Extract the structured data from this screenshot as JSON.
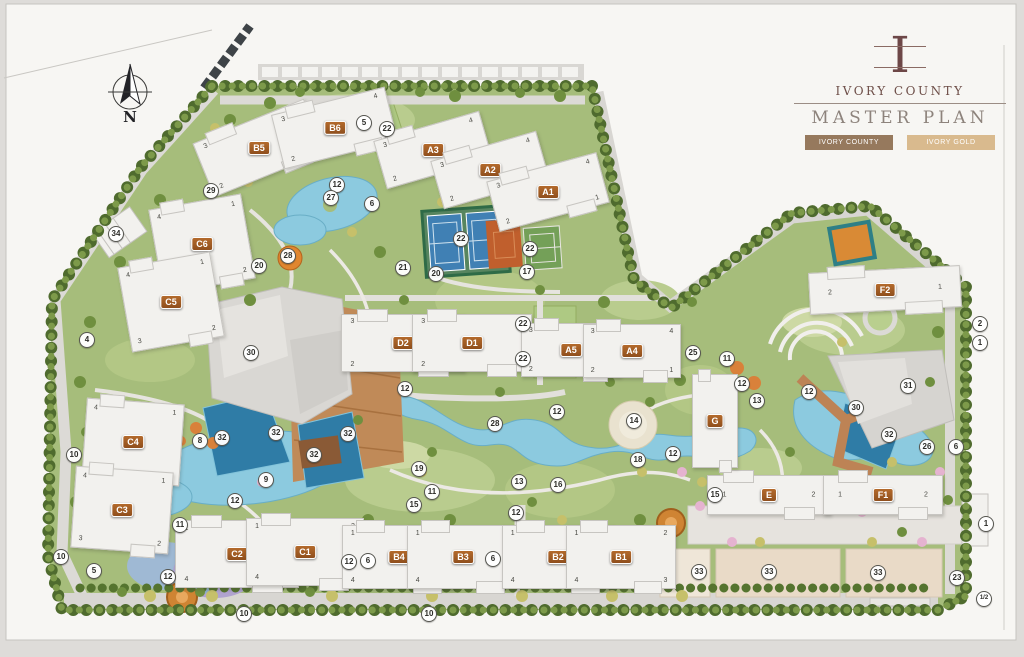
{
  "header": {
    "monogram": "I",
    "brand": "IVORY COUNTY",
    "title": "MASTER PLAN",
    "tabs": [
      {
        "label": "IVORY COUNTY",
        "active": true
      },
      {
        "label": "IVORY GOLD",
        "active": false
      }
    ]
  },
  "colors": {
    "tab_active_bg": "#96795d",
    "tab_inactive_bg": "#d9ba8e",
    "building_chip": "#a85c22",
    "brand_text": "#6e4f49",
    "title_text": "#8d837c",
    "water": "#8ccadf",
    "pool": "#2f7ca6",
    "site_green": "#a6bd7b"
  },
  "map": {
    "compass": "N",
    "buildings": [
      {
        "id": "B5",
        "x": 258,
        "y": 147,
        "w": 118,
        "h": 56,
        "rot": -22,
        "units": [
          "3",
          "4",
          "2",
          "1"
        ]
      },
      {
        "id": "B6",
        "x": 333,
        "y": 127,
        "w": 115,
        "h": 54,
        "rot": -14,
        "units": [
          "3",
          "4",
          "2",
          "1"
        ]
      },
      {
        "id": "A3",
        "x": 432,
        "y": 149,
        "w": 108,
        "h": 48,
        "rot": -16,
        "units": [
          "3",
          "4",
          "2",
          "1"
        ]
      },
      {
        "id": "A2",
        "x": 489,
        "y": 169,
        "w": 108,
        "h": 48,
        "rot": -16,
        "units": [
          "3",
          "4",
          "2",
          "1"
        ]
      },
      {
        "id": "A1",
        "x": 547,
        "y": 191,
        "w": 112,
        "h": 50,
        "rot": -15,
        "units": [
          "3",
          "4",
          "2",
          "1"
        ]
      },
      {
        "id": "C6",
        "x": 201,
        "y": 243,
        "w": 92,
        "h": 84,
        "rot": -10,
        "units": [
          "4",
          "1",
          "3",
          "2"
        ]
      },
      {
        "id": "C5",
        "x": 170,
        "y": 301,
        "w": 92,
        "h": 84,
        "rot": -10,
        "units": [
          "4",
          "1",
          "3",
          "2"
        ]
      },
      {
        "id": "C4",
        "x": 132,
        "y": 441,
        "w": 96,
        "h": 80,
        "rot": 4,
        "units": [
          "4",
          "1",
          "3",
          "2"
        ]
      },
      {
        "id": "C3",
        "x": 121,
        "y": 509,
        "w": 96,
        "h": 80,
        "rot": 4,
        "units": [
          "4",
          "1",
          "3",
          "2"
        ]
      },
      {
        "id": "C2",
        "x": 236,
        "y": 553,
        "w": 122,
        "h": 66,
        "rot": 0,
        "units": [
          "1",
          "2",
          "4",
          "3"
        ]
      },
      {
        "id": "C1",
        "x": 304,
        "y": 551,
        "w": 116,
        "h": 66,
        "rot": 0,
        "units": [
          "1",
          "2",
          "4",
          "3"
        ]
      },
      {
        "id": "B4",
        "x": 398,
        "y": 556,
        "w": 112,
        "h": 62,
        "rot": 0,
        "units": [
          "1",
          "2",
          "4",
          "3"
        ]
      },
      {
        "id": "B3",
        "x": 462,
        "y": 556,
        "w": 110,
        "h": 62,
        "rot": 0,
        "units": [
          "1",
          "2",
          "4",
          "3"
        ]
      },
      {
        "id": "B2",
        "x": 557,
        "y": 556,
        "w": 110,
        "h": 62,
        "rot": 0,
        "units": [
          "1",
          "2",
          "4",
          "3"
        ]
      },
      {
        "id": "B1",
        "x": 620,
        "y": 556,
        "w": 108,
        "h": 62,
        "rot": 0,
        "units": [
          "1",
          "2",
          "4",
          "3"
        ]
      },
      {
        "id": "D2",
        "x": 402,
        "y": 342,
        "w": 122,
        "h": 56,
        "rot": 0,
        "units": [
          "3",
          "4",
          "2",
          "1"
        ]
      },
      {
        "id": "D1",
        "x": 471,
        "y": 342,
        "w": 118,
        "h": 56,
        "rot": 0,
        "units": [
          "3",
          "4",
          "2",
          "1"
        ]
      },
      {
        "id": "A5",
        "x": 570,
        "y": 349,
        "w": 98,
        "h": 52,
        "rot": 0,
        "units": [
          "3",
          "4",
          "2",
          "1"
        ]
      },
      {
        "id": "A4",
        "x": 631,
        "y": 350,
        "w": 96,
        "h": 52,
        "rot": 0,
        "units": [
          "3",
          "4",
          "2",
          "1"
        ]
      },
      {
        "id": "E",
        "x": 768,
        "y": 494,
        "w": 122,
        "h": 38,
        "rot": 0,
        "units": [
          "1",
          "2"
        ]
      },
      {
        "id": "F1",
        "x": 882,
        "y": 494,
        "w": 118,
        "h": 38,
        "rot": 0,
        "units": [
          "1",
          "2"
        ]
      },
      {
        "id": "F2",
        "x": 884,
        "y": 289,
        "w": 150,
        "h": 40,
        "rot": -3,
        "units": [
          "2",
          "1"
        ]
      },
      {
        "id": "G",
        "x": 714,
        "y": 420,
        "w": 44,
        "h": 92,
        "rot": 0,
        "units": []
      }
    ],
    "markers": [
      {
        "n": "29",
        "x": 210,
        "y": 190
      },
      {
        "n": "12",
        "x": 336,
        "y": 184
      },
      {
        "n": "27",
        "x": 330,
        "y": 197
      },
      {
        "n": "5",
        "x": 363,
        "y": 122
      },
      {
        "n": "22",
        "x": 386,
        "y": 128
      },
      {
        "n": "6",
        "x": 371,
        "y": 203
      },
      {
        "n": "21",
        "x": 402,
        "y": 267
      },
      {
        "n": "20",
        "x": 435,
        "y": 273
      },
      {
        "n": "22",
        "x": 460,
        "y": 238
      },
      {
        "n": "22",
        "x": 529,
        "y": 248
      },
      {
        "n": "17",
        "x": 526,
        "y": 271
      },
      {
        "n": "34",
        "x": 115,
        "y": 233
      },
      {
        "n": "20",
        "x": 258,
        "y": 265
      },
      {
        "n": "28",
        "x": 287,
        "y": 255
      },
      {
        "n": "30",
        "x": 250,
        "y": 352
      },
      {
        "n": "12",
        "x": 404,
        "y": 388
      },
      {
        "n": "22",
        "x": 522,
        "y": 323
      },
      {
        "n": "22",
        "x": 522,
        "y": 358
      },
      {
        "n": "25",
        "x": 692,
        "y": 352
      },
      {
        "n": "11",
        "x": 726,
        "y": 358
      },
      {
        "n": "12",
        "x": 741,
        "y": 383
      },
      {
        "n": "13",
        "x": 756,
        "y": 400
      },
      {
        "n": "12",
        "x": 808,
        "y": 391
      },
      {
        "n": "31",
        "x": 907,
        "y": 385
      },
      {
        "n": "30",
        "x": 855,
        "y": 407
      },
      {
        "n": "32",
        "x": 888,
        "y": 434
      },
      {
        "n": "26",
        "x": 926,
        "y": 446
      },
      {
        "n": "6",
        "x": 955,
        "y": 446
      },
      {
        "n": "2",
        "x": 979,
        "y": 323
      },
      {
        "n": "1",
        "x": 979,
        "y": 342
      },
      {
        "n": "1",
        "x": 985,
        "y": 523
      },
      {
        "n": "23",
        "x": 956,
        "y": 577
      },
      {
        "n": "1/2",
        "x": 983,
        "y": 598
      },
      {
        "n": "8",
        "x": 199,
        "y": 440
      },
      {
        "n": "32",
        "x": 221,
        "y": 437
      },
      {
        "n": "32",
        "x": 275,
        "y": 432
      },
      {
        "n": "32",
        "x": 313,
        "y": 454
      },
      {
        "n": "32",
        "x": 347,
        "y": 433
      },
      {
        "n": "9",
        "x": 265,
        "y": 479
      },
      {
        "n": "12",
        "x": 234,
        "y": 500
      },
      {
        "n": "11",
        "x": 179,
        "y": 524
      },
      {
        "n": "5",
        "x": 93,
        "y": 570
      },
      {
        "n": "12",
        "x": 167,
        "y": 576
      },
      {
        "n": "10",
        "x": 60,
        "y": 556
      },
      {
        "n": "10",
        "x": 73,
        "y": 454
      },
      {
        "n": "4",
        "x": 86,
        "y": 339
      },
      {
        "n": "10",
        "x": 243,
        "y": 613
      },
      {
        "n": "10",
        "x": 428,
        "y": 613
      },
      {
        "n": "12",
        "x": 348,
        "y": 561
      },
      {
        "n": "6",
        "x": 367,
        "y": 560
      },
      {
        "n": "6",
        "x": 492,
        "y": 558
      },
      {
        "n": "12",
        "x": 515,
        "y": 512
      },
      {
        "n": "19",
        "x": 418,
        "y": 468
      },
      {
        "n": "11",
        "x": 431,
        "y": 491
      },
      {
        "n": "15",
        "x": 413,
        "y": 504
      },
      {
        "n": "13",
        "x": 518,
        "y": 481
      },
      {
        "n": "16",
        "x": 557,
        "y": 484
      },
      {
        "n": "28",
        "x": 494,
        "y": 423
      },
      {
        "n": "12",
        "x": 556,
        "y": 411
      },
      {
        "n": "14",
        "x": 633,
        "y": 420
      },
      {
        "n": "18",
        "x": 637,
        "y": 459
      },
      {
        "n": "12",
        "x": 672,
        "y": 453
      },
      {
        "n": "15",
        "x": 714,
        "y": 494
      },
      {
        "n": "33",
        "x": 698,
        "y": 571
      },
      {
        "n": "33",
        "x": 768,
        "y": 571
      },
      {
        "n": "33",
        "x": 877,
        "y": 572
      }
    ]
  }
}
